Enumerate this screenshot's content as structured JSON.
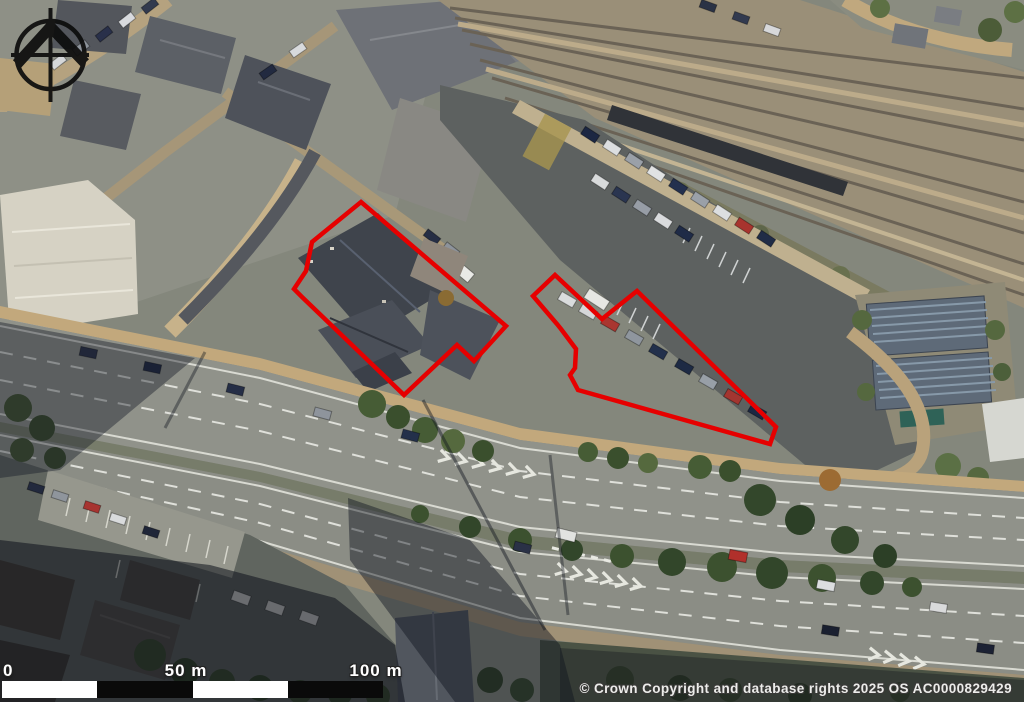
{
  "map": {
    "description": "aerial-photograph-site-location-plan",
    "attribution": "© Crown Copyright and database rights 2025 OS AC0000829429",
    "scale_bar": {
      "label_0": "0",
      "label_50": "50 m",
      "label_100": "100 m"
    },
    "site_boundaries": {
      "color": "#e60000",
      "stroke_width": 4.5,
      "polygons": [
        {
          "name": "west-site-boundary",
          "points": "361,202 506,326 474,361 457,345 404,395 302,297 294,289 306,271 312,242"
        },
        {
          "name": "east-site-boundary",
          "points": "555,275 602,319 637,291 776,427 770,444 578,390 570,375 575,368 576,349 561,329 557,324 533,296"
        }
      ]
    },
    "north_arrow_icon": "north-arrow-compass"
  }
}
